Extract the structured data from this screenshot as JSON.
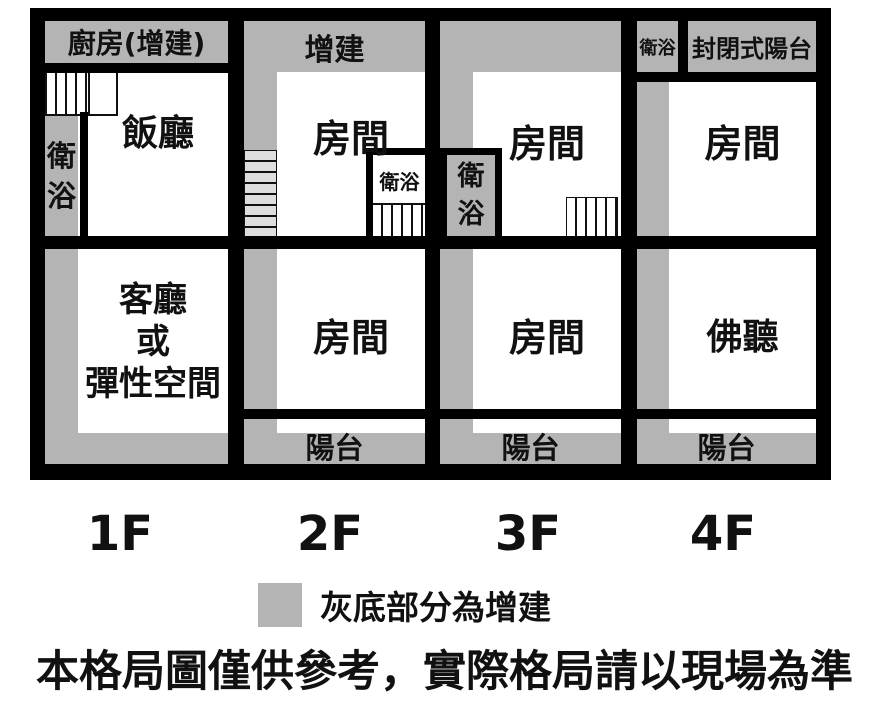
{
  "colors": {
    "addition_gray": "#b4b4b4",
    "wall": "#000000",
    "stair_fill": "#dedede"
  },
  "floors": [
    {
      "name": "1F",
      "rooms": {
        "kitchen": "廚房(增建)",
        "bath": "衛\n浴",
        "dining": "飯廳",
        "living": "客廳\n或\n彈性空間"
      }
    },
    {
      "name": "2F",
      "rooms": {
        "addition": "增建",
        "room_upper": "房間",
        "bath": "衛浴",
        "room_lower": "房間",
        "balcony": "陽台"
      }
    },
    {
      "name": "3F",
      "rooms": {
        "room_upper": "房間",
        "bath": "衛\n浴",
        "room_lower": "房間",
        "balcony": "陽台"
      }
    },
    {
      "name": "4F",
      "rooms": {
        "bath": "衛浴",
        "enclosed_balcony": "封閉式陽台",
        "room_upper": "房間",
        "buddha_hall": "佛聽",
        "balcony": "陽台"
      }
    }
  ],
  "legend": {
    "label": "灰底部分為增建"
  },
  "disclaimer": "本格局圖僅供參考，實際格局請以現場為準"
}
